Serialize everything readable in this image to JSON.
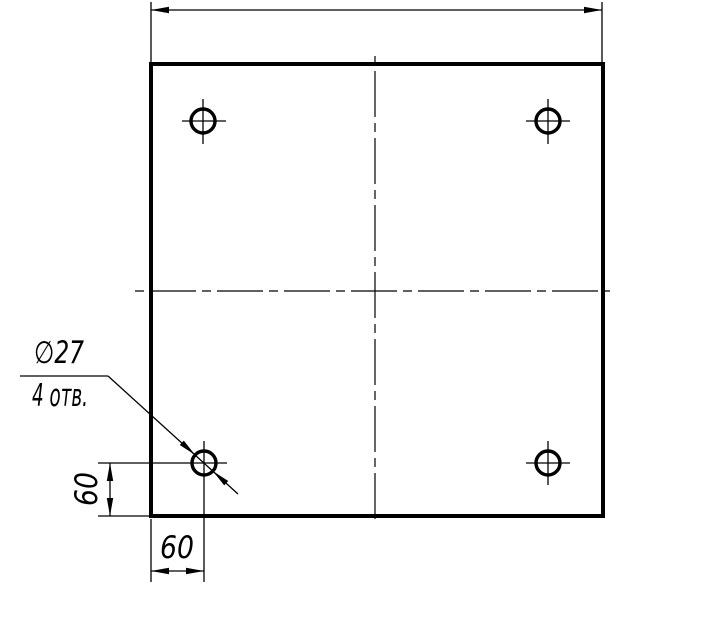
{
  "drawing": {
    "colors": {
      "ink": "#000000",
      "background": "#ffffff"
    },
    "callout": {
      "diameter_label": "∅27",
      "count_label": "4 отв."
    },
    "dimensions": {
      "vertical_offset_label": "60",
      "horizontal_offset_label": "60",
      "top_overall_label": ""
    },
    "holes": {
      "count": 4,
      "diameter": 27,
      "edge_offset": 60
    }
  }
}
